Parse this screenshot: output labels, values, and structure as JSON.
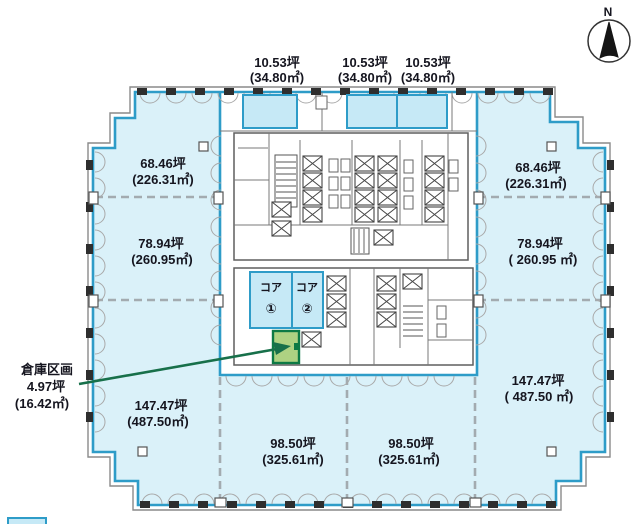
{
  "compass": {
    "north_label": "N"
  },
  "areas": {
    "top": [
      {
        "tsubo": "10.53坪",
        "sqm": "(34.80㎡)"
      },
      {
        "tsubo": "10.53坪",
        "sqm": "(34.80㎡)"
      },
      {
        "tsubo": "10.53坪",
        "sqm": "(34.80㎡)"
      }
    ],
    "left": [
      {
        "tsubo": "68.46坪",
        "sqm": "(226.31㎡)"
      },
      {
        "tsubo": "78.94坪",
        "sqm": "(260.95㎡)"
      },
      {
        "tsubo": "147.47坪",
        "sqm": "(487.50㎡)"
      }
    ],
    "right": [
      {
        "tsubo": "68.46坪",
        "sqm": "(226.31㎡)"
      },
      {
        "tsubo": "78.94坪",
        "sqm": "( 260.95 ㎡)"
      },
      {
        "tsubo": "147.47坪",
        "sqm": "( 487.50 ㎡)"
      }
    ],
    "bottom": [
      {
        "tsubo": "98.50坪",
        "sqm": "(325.61㎡)"
      },
      {
        "tsubo": "98.50坪",
        "sqm": "(325.61㎡)"
      }
    ]
  },
  "cores": [
    {
      "label": "コア",
      "number": "①"
    },
    {
      "label": "コア",
      "number": "②"
    }
  ],
  "warehouse": {
    "title": "倉庫区画",
    "tsubo": "4.97坪",
    "sqm": "(16.42㎡)"
  },
  "colors": {
    "office_fill": "#daf1f9",
    "small_room_fill": "#c6e9f6",
    "room_border": "#2e9cc8",
    "warehouse_fill": "#aed282",
    "warehouse_border": "#0d7a45",
    "arrow_green": "#17704a",
    "divider_gray": "#a3abb0",
    "wall_gray": "#5f5f5f",
    "text": "#15151f"
  }
}
